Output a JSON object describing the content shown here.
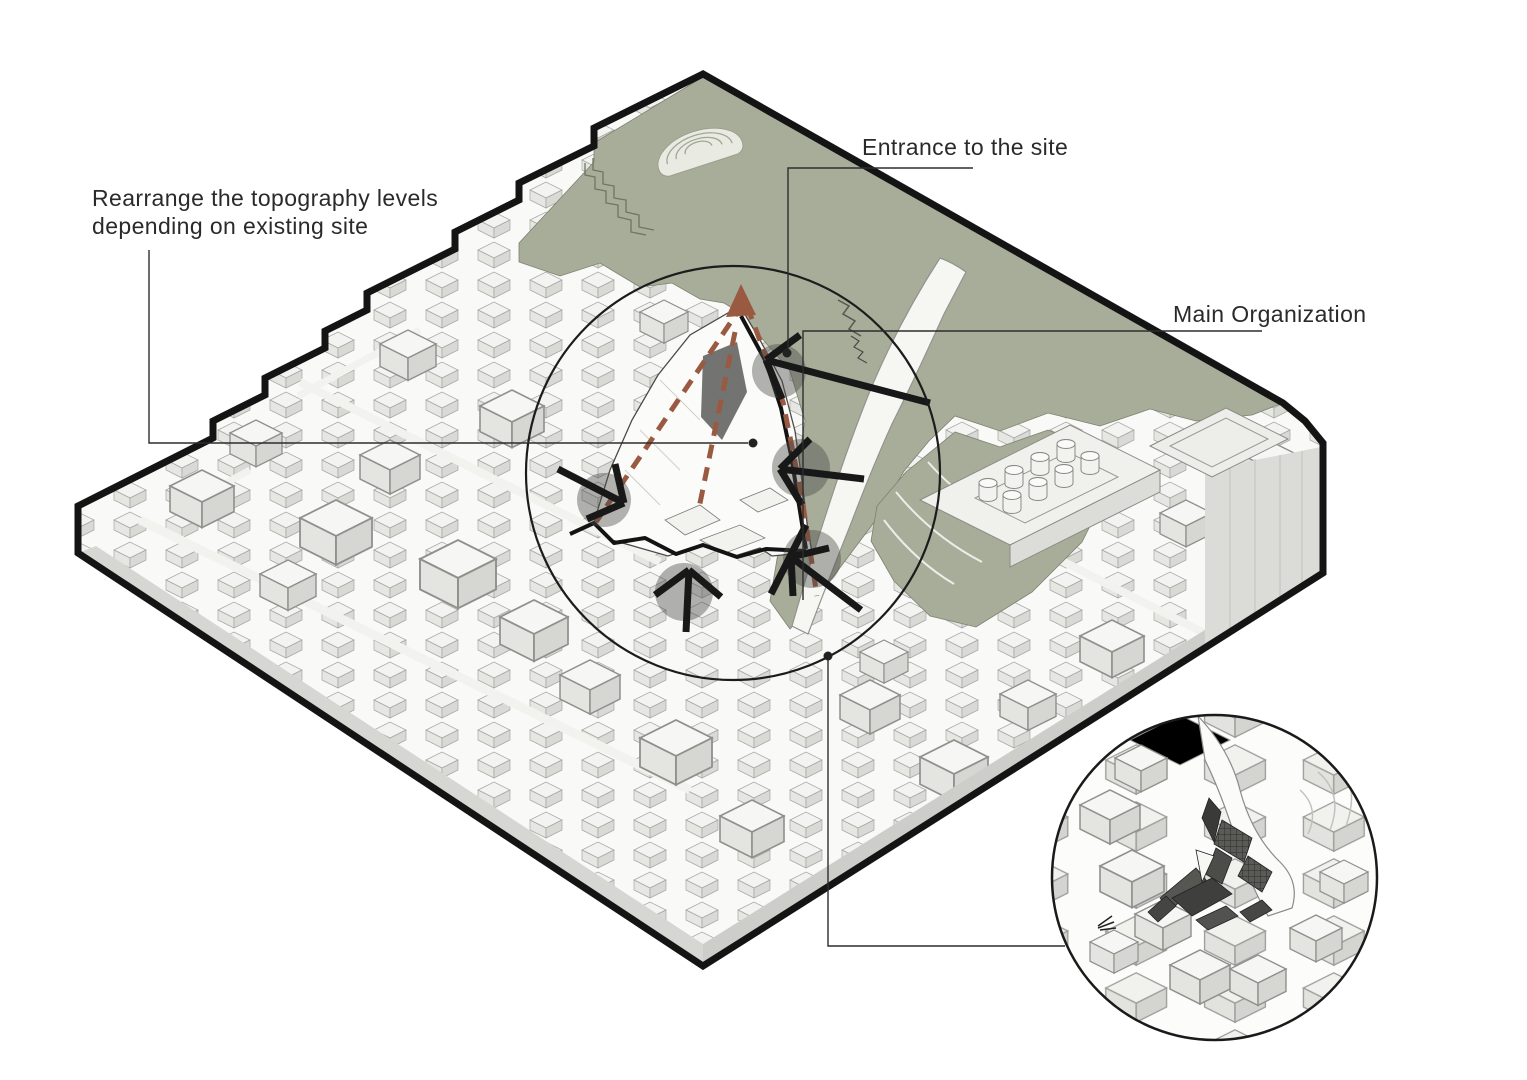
{
  "page": {
    "type": "architectural site analysis diagram",
    "background": "#ffffff"
  },
  "labels": {
    "topography": {
      "line1": "Rearrange the topography levels",
      "line2": "depending on existing site"
    },
    "entrance": {
      "text": "Entrance to the site"
    },
    "organization": {
      "text": "Main Organization"
    }
  },
  "colors": {
    "park_green": "#a8ad9a",
    "route_brown": "#9a5a42",
    "ink": "#141414",
    "leader": "#2d2d2d",
    "marker_gray": "rgba(75,75,72,0.42)"
  },
  "markers": {
    "entry_arrow_count": 5,
    "has_site_focus_circle": true,
    "has_detail_inset_circle": true
  }
}
